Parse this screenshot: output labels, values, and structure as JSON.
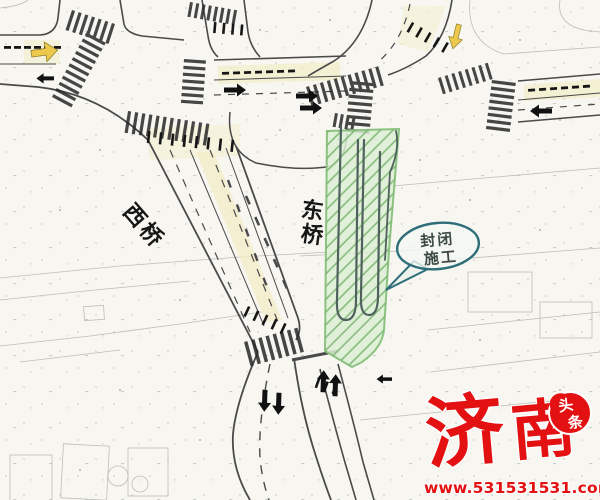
{
  "labels": {
    "west_bridge": "西桥",
    "east_bridge_chars": [
      "东",
      "桥"
    ]
  },
  "callout": {
    "line1": "封闭",
    "line2": "施工"
  },
  "watermark": {
    "brand_chars": [
      "济",
      "南"
    ],
    "badge_chars": [
      "头",
      "条"
    ],
    "url": "www.531531531.com"
  },
  "colors": {
    "construction_green": "#dcefd5",
    "hatch_green": "#7cb471",
    "zone_border": "#8cc280",
    "callout_teal": "#2d6e79",
    "watermark_red": "#e31111",
    "lane_yellow": "#ecc84d"
  }
}
